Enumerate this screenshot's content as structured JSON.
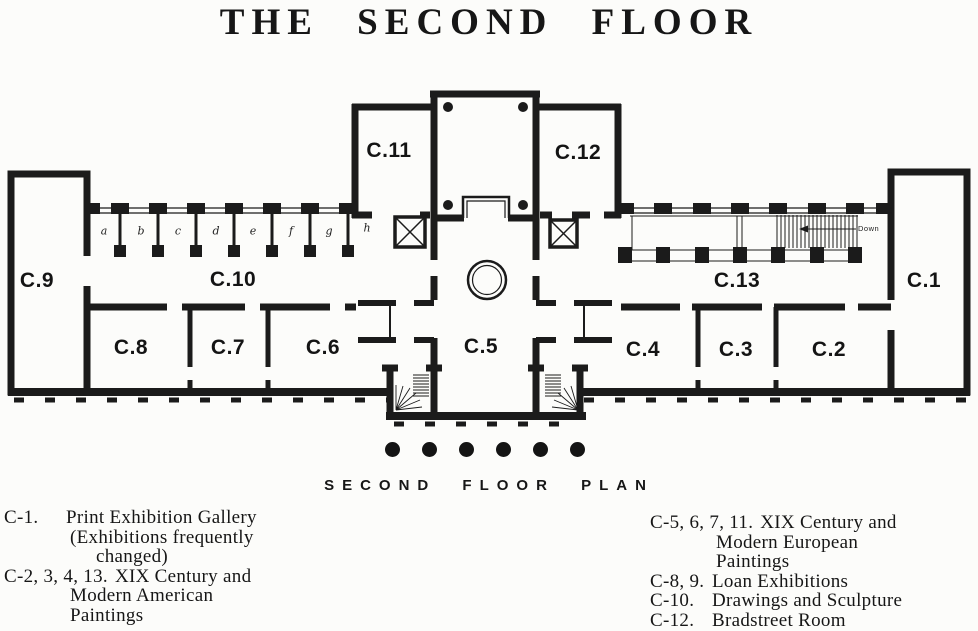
{
  "title": "THE SECOND FLOOR",
  "plan": {
    "caption": "SECOND FLOOR PLAN",
    "ramp_label": "Down",
    "rooms": {
      "c1": "C.1",
      "c2": "C.2",
      "c3": "C.3",
      "c4": "C.4",
      "c5": "C.5",
      "c6": "C.6",
      "c7": "C.7",
      "c8": "C.8",
      "c9": "C.9",
      "c10": "C.10",
      "c11": "C.11",
      "c12": "C.12",
      "c13": "C.13"
    },
    "alcoves": [
      "a",
      "b",
      "c",
      "d",
      "e",
      "f",
      "g",
      "h"
    ]
  },
  "legend": {
    "left": [
      {
        "key": "C-1.",
        "line1": "Print Exhibition Gallery",
        "line2": "(Exhibitions frequently",
        "line3": "changed)"
      },
      {
        "key": "C-2, 3, 4, 13.",
        "line1": "XIX Century and",
        "line2": "Modern American",
        "line3": "Paintings"
      }
    ],
    "right": [
      {
        "key": "C-5, 6, 7, 11.",
        "line1": "XIX Century and",
        "line2": "Modern European",
        "line3": "Paintings"
      },
      {
        "key": "C-8, 9.",
        "line1": "Loan Exhibitions"
      },
      {
        "key": "C-10.",
        "line1": "Drawings and Sculpture"
      },
      {
        "key": "C-12.",
        "line1": "Bradstreet Room"
      }
    ]
  }
}
